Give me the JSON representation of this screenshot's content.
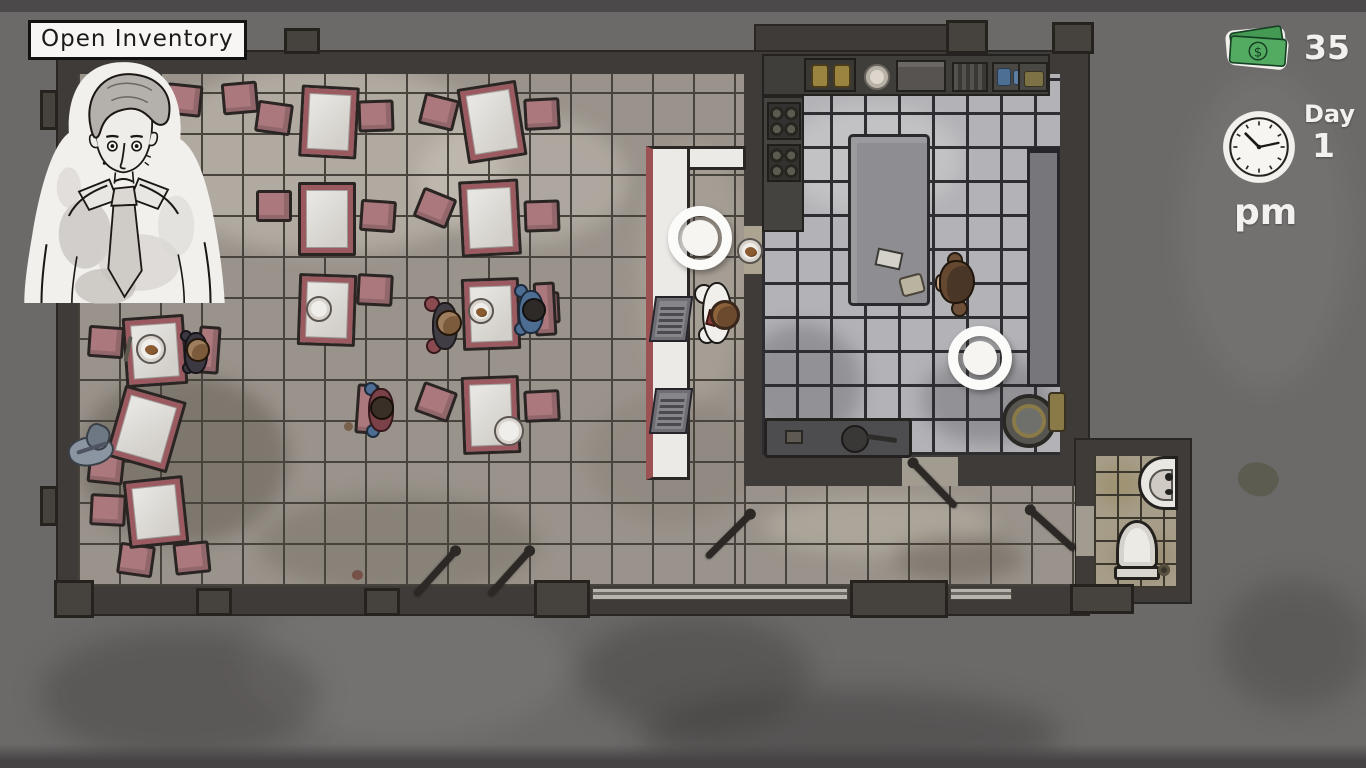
{
  "hud": {
    "open_inventory_label": "Open Inventory",
    "money_amount": "35",
    "currency_symbol": "$",
    "day_label": "Day",
    "day_number": "1",
    "meridiem": "pm"
  },
  "palette": {
    "money_green": "#52ab60",
    "chair_pink": "#ab787d",
    "table_trim_maroon": "#9a5a60",
    "counter_red_stripe": "#9c5252",
    "wall_dark": "#3e3b39",
    "marker_white": "#fbfbf9"
  },
  "scene": {
    "rooms": [
      "dining-room",
      "bar-counter",
      "kitchen",
      "bathroom"
    ],
    "characters": [
      "waiter-carrying-plate",
      "chef",
      "customer",
      "customer",
      "customer",
      "customer"
    ],
    "interaction_markers": [
      "bar-marker",
      "kitchen-marker"
    ],
    "fixtures": [
      "dining-tables",
      "chairs",
      "cash-registers",
      "stoves",
      "deep-fryer",
      "kitchen-island",
      "prep-table",
      "stock-pot",
      "dish-sink",
      "toilet",
      "wash-basin",
      "mop-rag",
      "service-plate"
    ]
  }
}
